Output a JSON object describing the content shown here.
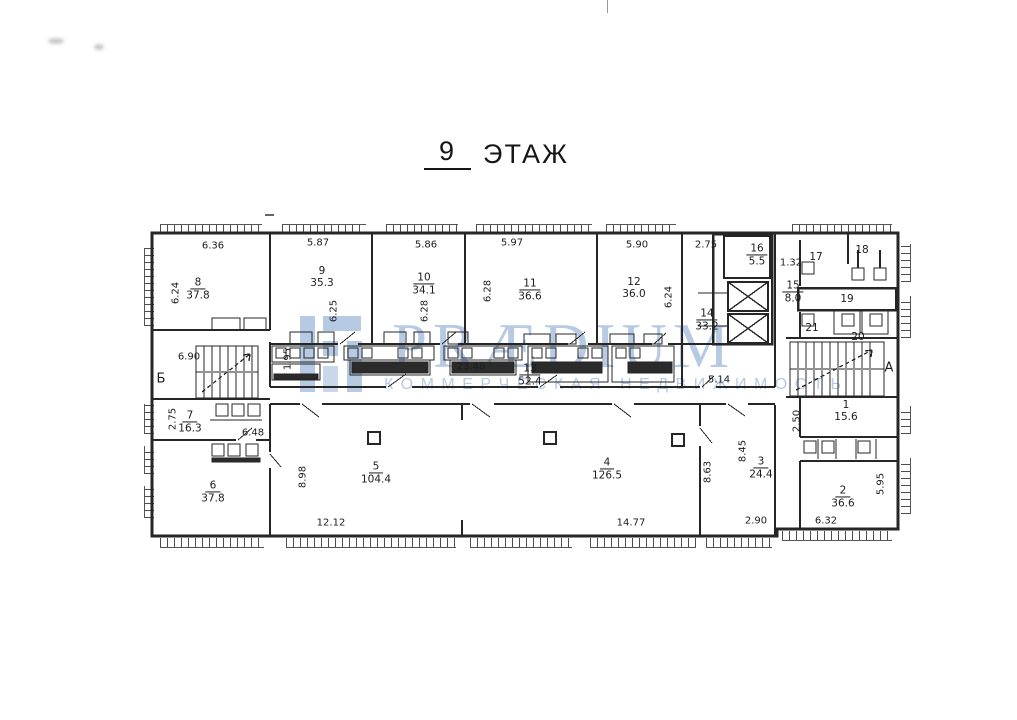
{
  "title": {
    "num": "9",
    "word": "ЭТАЖ"
  },
  "watermark": {
    "brand": "PRÆDIUM",
    "tagline": "КОММЕРЧЕСКАЯ НЕДВИЖИМОСТЬ",
    "color": "#b7cae3"
  },
  "axes": {
    "left": "Б",
    "right": "А"
  },
  "rooms": {
    "r1": {
      "num": "1",
      "area": "15.6"
    },
    "r2": {
      "num": "2",
      "area": "36.6"
    },
    "r3": {
      "num": "3",
      "area": "24.4"
    },
    "r4": {
      "num": "4",
      "area": "126.5"
    },
    "r5": {
      "num": "5",
      "area": "104.4"
    },
    "r6": {
      "num": "6",
      "area": "37.8"
    },
    "r7": {
      "num": "7",
      "area": "16.3"
    },
    "r8": {
      "num": "8",
      "area": "37.8"
    },
    "r9": {
      "num": "9",
      "area": "35.3"
    },
    "r10": {
      "num": "10",
      "area": "34.1"
    },
    "r11": {
      "num": "11",
      "area": "36.6"
    },
    "r12": {
      "num": "12",
      "area": "36.0"
    },
    "r13": {
      "num": "13",
      "area": "52.4"
    },
    "r14": {
      "num": "14",
      "area": "33.2"
    },
    "r15": {
      "num": "15",
      "area": "8.0"
    },
    "r16": {
      "num": "16",
      "area": "5.5"
    },
    "r17": {
      "num": "17"
    },
    "r18": {
      "num": "18"
    },
    "r19": {
      "num": "19"
    },
    "r20": {
      "num": "20"
    },
    "r21": {
      "num": "21"
    }
  },
  "dims": {
    "w8": "6.36",
    "w9": "5.87",
    "w10": "5.86",
    "w11": "5.97",
    "w12": "5.90",
    "cor_top": "2.75",
    "shaft": "1.32",
    "strip": "23.48",
    "cor_right": "5.14",
    "stair_l": "6.90",
    "r7_b": "6.48",
    "w5": "12.12",
    "w4": "14.77",
    "w3": "2.90",
    "w2": "6.32",
    "h8": "6.24",
    "h9": "6.25",
    "h10a": "6.28",
    "h10b": "6.28",
    "h12": "6.24",
    "strip_l": "1.95",
    "h7": "2.75",
    "h5": "8.98",
    "h4": "8.63",
    "h3": "8.45",
    "h1": "2.50",
    "h2": "5.95"
  }
}
